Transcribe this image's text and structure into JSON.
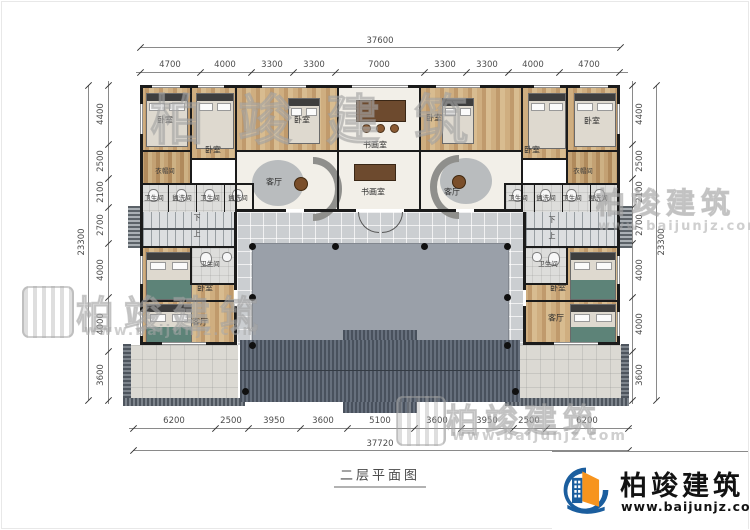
{
  "title": {
    "text": "二层平面图"
  },
  "brand": {
    "name": "柏竣建筑",
    "url": "www.baijunjz.com"
  },
  "rooms": {
    "bedroom": "卧室",
    "study": "书画室",
    "living": "客厅",
    "cloakroom": "衣帽间",
    "bathroom": "卫生间",
    "washroom": "盥洗间",
    "stairs_down": "下",
    "stairs_up": "上"
  },
  "dims": {
    "top": {
      "total": "37600",
      "segments": [
        "4700",
        "4000",
        "3300",
        "3300",
        "7000",
        "3300",
        "3300",
        "4000",
        "4700"
      ]
    },
    "bottom": {
      "total": "37720",
      "segments": [
        "6200",
        "2500",
        "3950",
        "3600",
        "5100",
        "3600",
        "3950",
        "2500",
        "6200"
      ]
    },
    "left": {
      "total": "23300",
      "segments": [
        "4400",
        "2500",
        "2100",
        "2700",
        "4000",
        "4000",
        "3600"
      ]
    },
    "right": {
      "total": "23300",
      "segments": [
        "4400",
        "2500",
        "2100",
        "2700",
        "4000",
        "4000",
        "3600"
      ]
    }
  },
  "colors": {
    "wall": "#1b1b1b",
    "wood_floor": "#c9a878",
    "courtyard": "#cbced1",
    "inner_court": "#9aa0a9",
    "roof": "#57606d",
    "logo_blue": "#1b5e9e",
    "logo_orange": "#f7941e"
  }
}
